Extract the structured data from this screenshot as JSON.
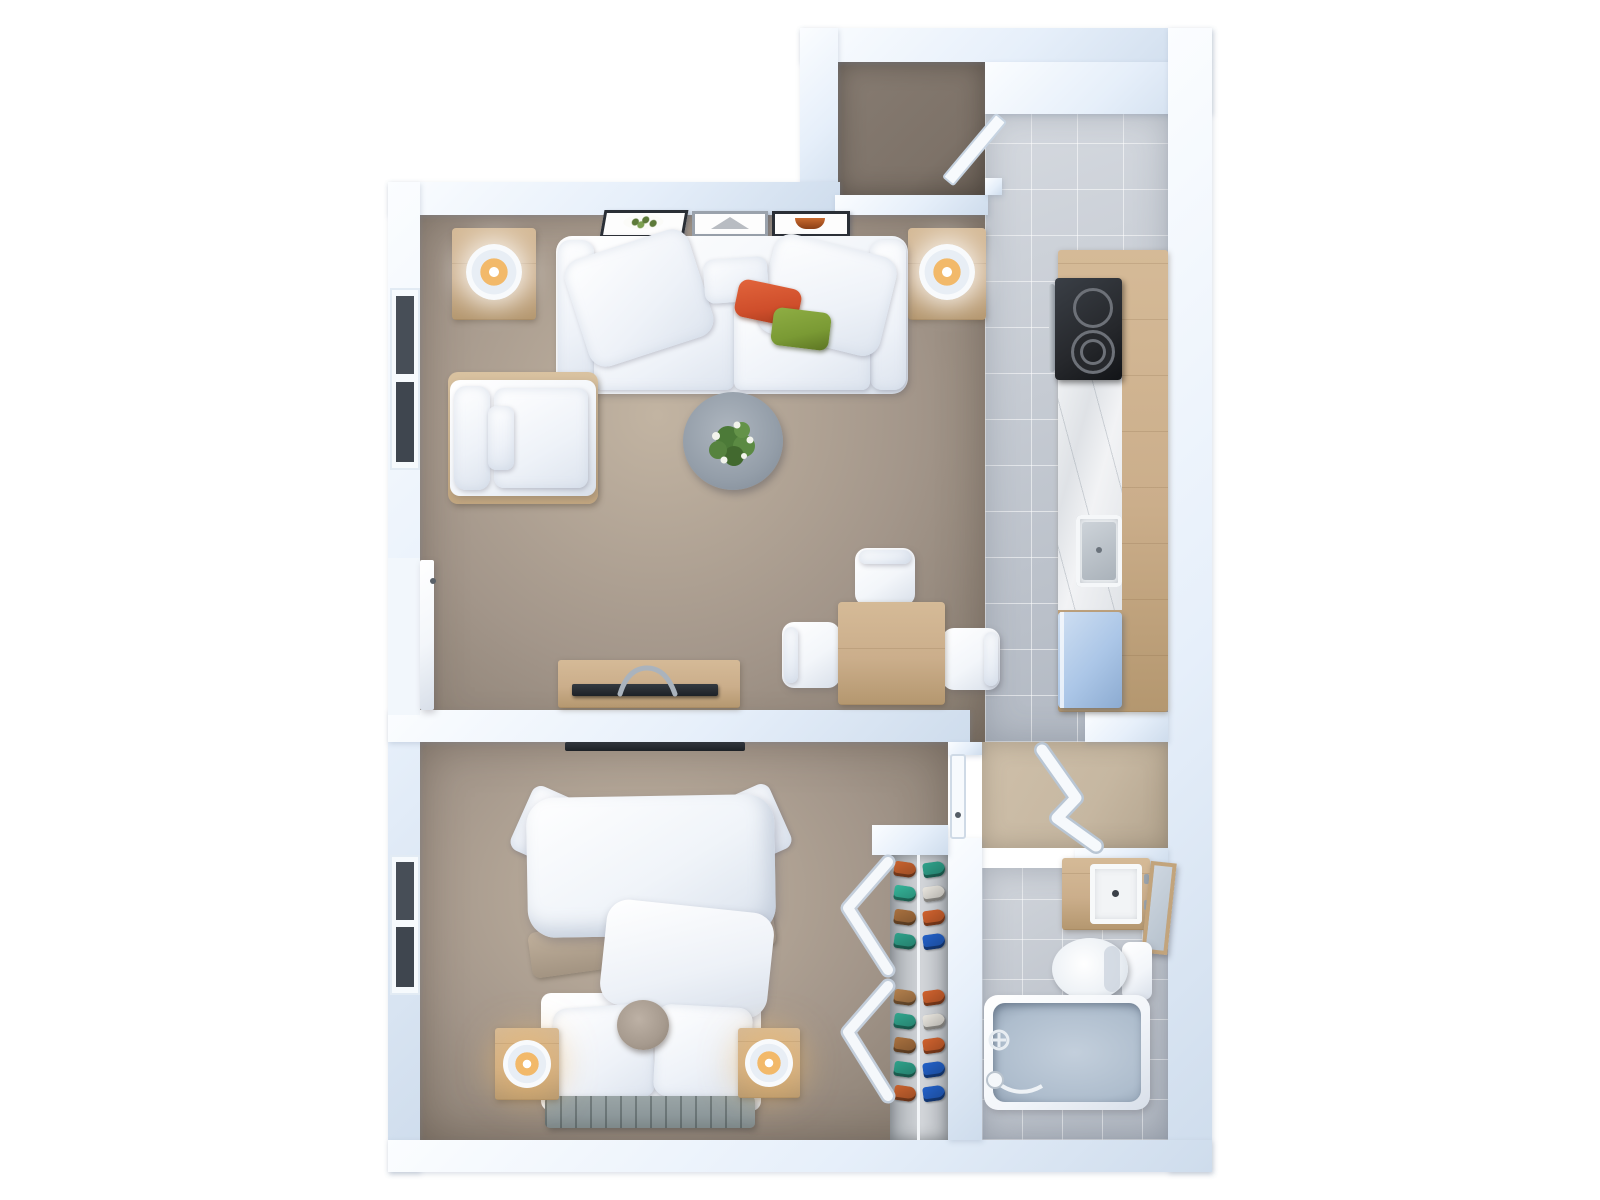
{
  "scene": {
    "view": "top-down 3D rendered floor plan",
    "rooms": [
      {
        "name": "living-room"
      },
      {
        "name": "kitchen"
      },
      {
        "name": "entry-vestibule"
      },
      {
        "name": "entry-storage-closet"
      },
      {
        "name": "bedroom"
      },
      {
        "name": "shoe-closet"
      },
      {
        "name": "hallway"
      },
      {
        "name": "bathroom"
      }
    ],
    "objects": [
      "sofa",
      "throw-pillow-red",
      "throw-pillow-green",
      "coffee-table",
      "potted-plant",
      "armchair",
      "side-table-with-lamp-left",
      "side-table-with-lamp-right",
      "wall-art-floral",
      "wall-art-triangle",
      "wall-art-semicircle",
      "tv-console",
      "television",
      "dining-table",
      "dining-chair",
      "dining-chair",
      "dining-chair",
      "kitchen-counter",
      "cooktop",
      "kitchen-sink",
      "refrigerator",
      "bed",
      "duvet",
      "bed-pillow",
      "bed-pillow",
      "round-pouf",
      "foot-bench",
      "nightstand-with-lamp-left",
      "nightstand-with-lamp-right",
      "bedroom-tv",
      "bedroom-window",
      "living-room-window",
      "balcony-door",
      "front-door",
      "bedroom-door",
      "accordion-door",
      "bifold-closet-doors",
      "shoe-rack",
      "bathroom-vanity",
      "bathroom-sink",
      "leaning-mirror",
      "toilet",
      "bathtub",
      "tub-faucet",
      "hand-shower"
    ]
  },
  "palette": {
    "background": "#ffffff",
    "wall": "#e6effa",
    "wall_shadow": "#cedcec",
    "floor_taupe": "#a3968a",
    "floor_taupe_dark": "#84796d",
    "floor_taupe_light": "#c2b4a2",
    "tile_kitchen": "#c3c9d2",
    "tile_bath": "#bec4cd",
    "floor_hall": "#c6b7a1",
    "floor_entry_closet": "#7d7268",
    "wood": "#cbae8b",
    "wood_dark": "#b4976f",
    "white_furniture": "#f3f6fa",
    "furniture_shadow": "#d8dfe9",
    "stove": "#26282c",
    "fridge": "#abc6e7",
    "tub": "#aebdcd",
    "pillow_red": "#cf4e2b",
    "pillow_green": "#7a9a34",
    "lamp_glow": "#f2b96a",
    "plant_green": "#51803c",
    "bench": "#8d989b",
    "pouf": "#a69a8e",
    "tv_black": "#1d2126",
    "metal": "#9aa4ae",
    "art_green": "#5d7a3a",
    "art_orange": "#c96a2e",
    "art_gray": "#b8bcc2"
  },
  "closet": {
    "shoes": [
      "#c9632f",
      "#2fa28b",
      "#35b59a",
      "#e9e6df",
      "#a9713f",
      "#d0622e",
      "#2fa28b",
      "#2361c8",
      "#b3804d",
      "#d0622e",
      "#31a68e",
      "#e9e6df",
      "#a9713f",
      "#d0622e",
      "#2fa28b",
      "#2361c8",
      "#c9632f",
      "#2361c8"
    ]
  }
}
